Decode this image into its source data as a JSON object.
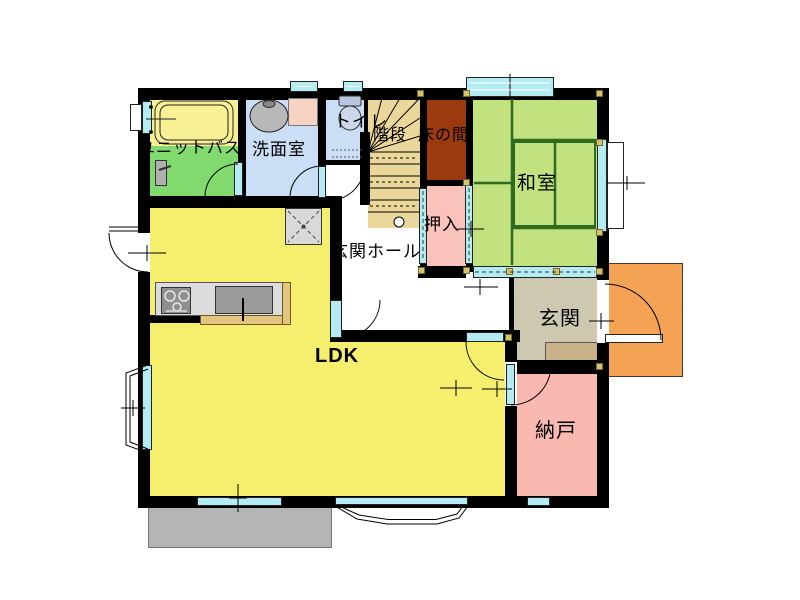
{
  "rooms": {
    "unit_bath": {
      "label": "ユニットバス"
    },
    "washroom": {
      "label": "洗面室"
    },
    "toilet": {
      "label": "トイレ"
    },
    "stairs": {
      "label": "階段"
    },
    "tokonoma": {
      "label": "床の間"
    },
    "washitsu": {
      "label": "和室"
    },
    "oshiire": {
      "label": "押入"
    },
    "hall": {
      "label": "玄関ホール"
    },
    "genkan": {
      "label": "玄関"
    },
    "ldk": {
      "label": "LDK"
    },
    "nando": {
      "label": "納戸"
    }
  },
  "colors": {
    "wall": "#000000",
    "window": "#b5ecf4",
    "ldk": "#f6ee6d",
    "washitsu_tatami": "#c1e27e",
    "tatami_line": "#2e6b1e",
    "unit_bath_floor": "#82d96e",
    "bathtub": "#f7f095",
    "washroom": "#cadef5",
    "toilet": "#cadef5",
    "stairs": "#ecd79b",
    "tokonoma": "#9c3a0f",
    "oshiire": "#f9c2bb",
    "nando": "#f9b9b1",
    "genkan": "#cdc8af",
    "genkan_step": "#c9b188",
    "porch": "#f4a254",
    "deck": "#b5b5b5",
    "counter": "#dcdcdc",
    "appliance": "#8f8f8f",
    "counter_edge": "#e3c582",
    "pillar_marker": "#d2c269",
    "sink_counter": "#f7d3c3"
  }
}
